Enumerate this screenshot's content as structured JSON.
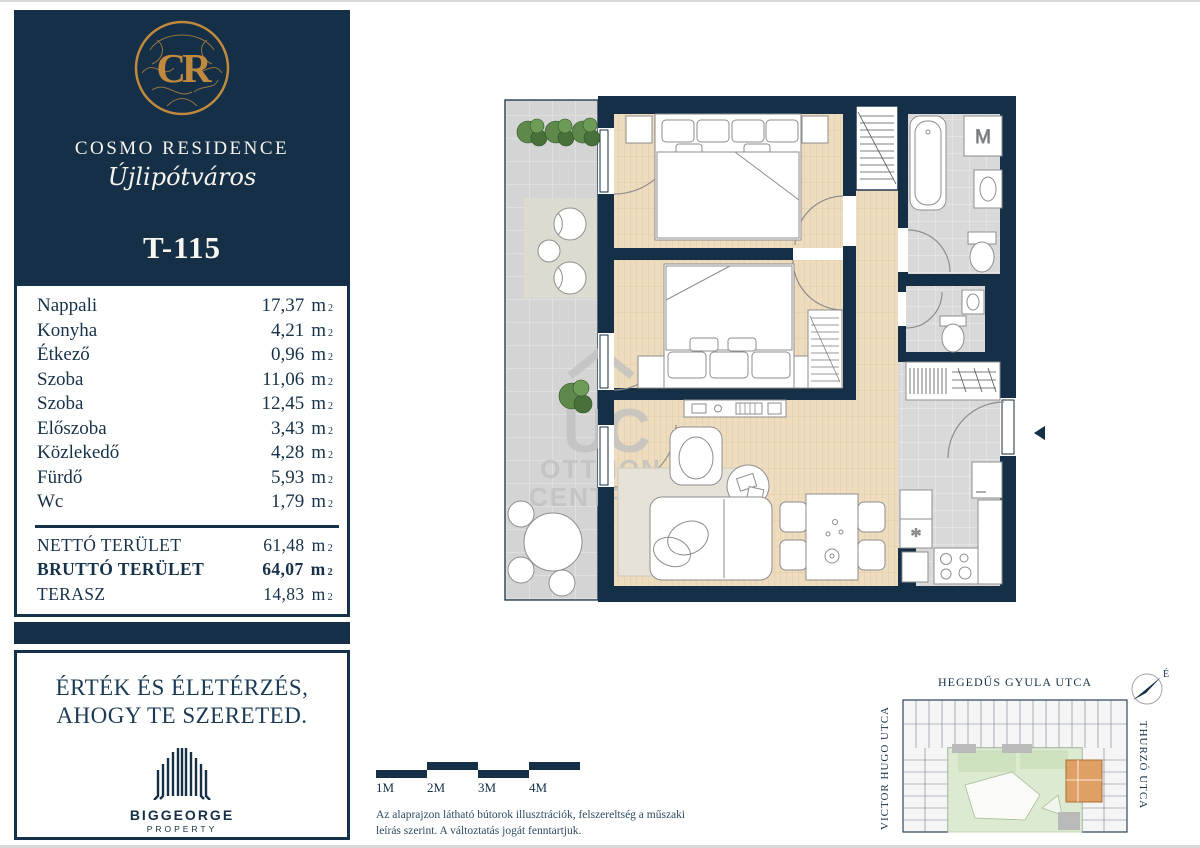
{
  "brand": {
    "monogram": "CR",
    "name": "COSMO RESIDENCE",
    "district": "Újlipótváros",
    "unit_id": "T-115"
  },
  "area_unit": "m",
  "area_sup": "2",
  "rooms": [
    {
      "label": "Nappali",
      "value": "17,37"
    },
    {
      "label": "Konyha",
      "value": "4,21"
    },
    {
      "label": "Étkező",
      "value": "0,96"
    },
    {
      "label": "Szoba",
      "value": "11,06"
    },
    {
      "label": "Szoba",
      "value": "12,45"
    },
    {
      "label": "Előszoba",
      "value": "3,43"
    },
    {
      "label": "Közlekedő",
      "value": "4,28"
    },
    {
      "label": "Fürdő",
      "value": "5,93"
    },
    {
      "label": "Wc",
      "value": "1,79"
    }
  ],
  "totals": [
    {
      "label": "NETTÓ TERÜLET",
      "value": "61,48"
    },
    {
      "label": "BRUTTÓ TERÜLET",
      "value": "64,07"
    },
    {
      "label": "TERASZ",
      "value": "14,83"
    }
  ],
  "slogan": {
    "line1": "ÉRTÉK ÉS ÉLETÉRZÉS,",
    "line2": "AHOGY TE SZERETED."
  },
  "developer": {
    "name": "BIGGEORGE",
    "sub": "PROPERTY"
  },
  "scalebar": {
    "labels": [
      "1M",
      "2M",
      "3M",
      "4M"
    ]
  },
  "disclaimer": "Az alaprajzon látható bútorok illusztrációk, felszereltség a műszaki leírás szerint. A változtatás jogát fenntartjuk.",
  "floorplan": {
    "washer_label": "M",
    "sink_symbol": "*",
    "watermark_mark": "UC",
    "watermark_line1": "OTTHON",
    "watermark_line2": "CENTRUM"
  },
  "sitemap": {
    "street_top": "HEGEDŰS GYULA UTCA",
    "street_left": "VICTOR HUGO UTCA",
    "street_right": "THURZÓ UTCA",
    "compass_label": "É"
  },
  "colors": {
    "navy": "#152f47",
    "gold": "#c08a3e",
    "wood_floor": "#eedcbf",
    "tile_gray": "#d9d9d9",
    "terrace_gray": "#d4d4d4",
    "courtyard_green": "#dcead2",
    "highlight_orange": "#dfa066"
  }
}
